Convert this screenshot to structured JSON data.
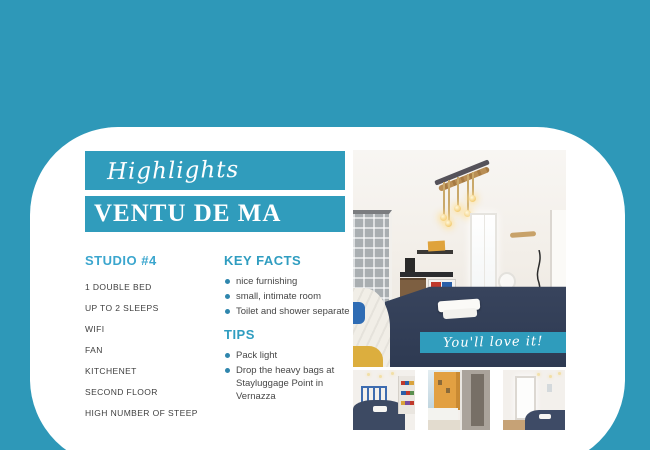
{
  "canvas": {
    "background_color": "#2E98B8",
    "card_color": "#FFFFFF"
  },
  "header": {
    "script_label": "Highlights",
    "title": "VENTU DE MA",
    "banner_color": "#309CBC"
  },
  "left_column": {
    "heading": "STUDIO #4",
    "items": [
      "1 DOUBLE BED",
      "UP TO 2 SLEEPS",
      "WIFI",
      "FAN",
      "KITCHENET",
      "SECOND FLOOR",
      "HIGH NUMBER OF STEEP"
    ]
  },
  "key_facts": {
    "heading": "KEY FACTS",
    "items": [
      "nice furnishing",
      "small, intimate room",
      "Toilet and shower separate"
    ]
  },
  "tips": {
    "heading": "TIPS",
    "items": [
      "Pack light",
      "Drop the heavy bags at Stayluggage Point in Vernazza"
    ]
  },
  "gallery": {
    "caption": "You'll love it!",
    "main_photo_desc": "studio room with rope pendant lights, kitchenette, shower and double bed",
    "thumbnails": [
      "bedroom with blue headboard and shelves",
      "balcony doorway with sea view",
      "room with bright door and bed corner"
    ]
  },
  "colors": {
    "accent_teal": "#309CBC",
    "heading_text": "#2F9DC0",
    "studio_heading_text": "#3BA6CE",
    "body_text": "#3E3E3E",
    "bullet_dot": "#2F86AD"
  }
}
